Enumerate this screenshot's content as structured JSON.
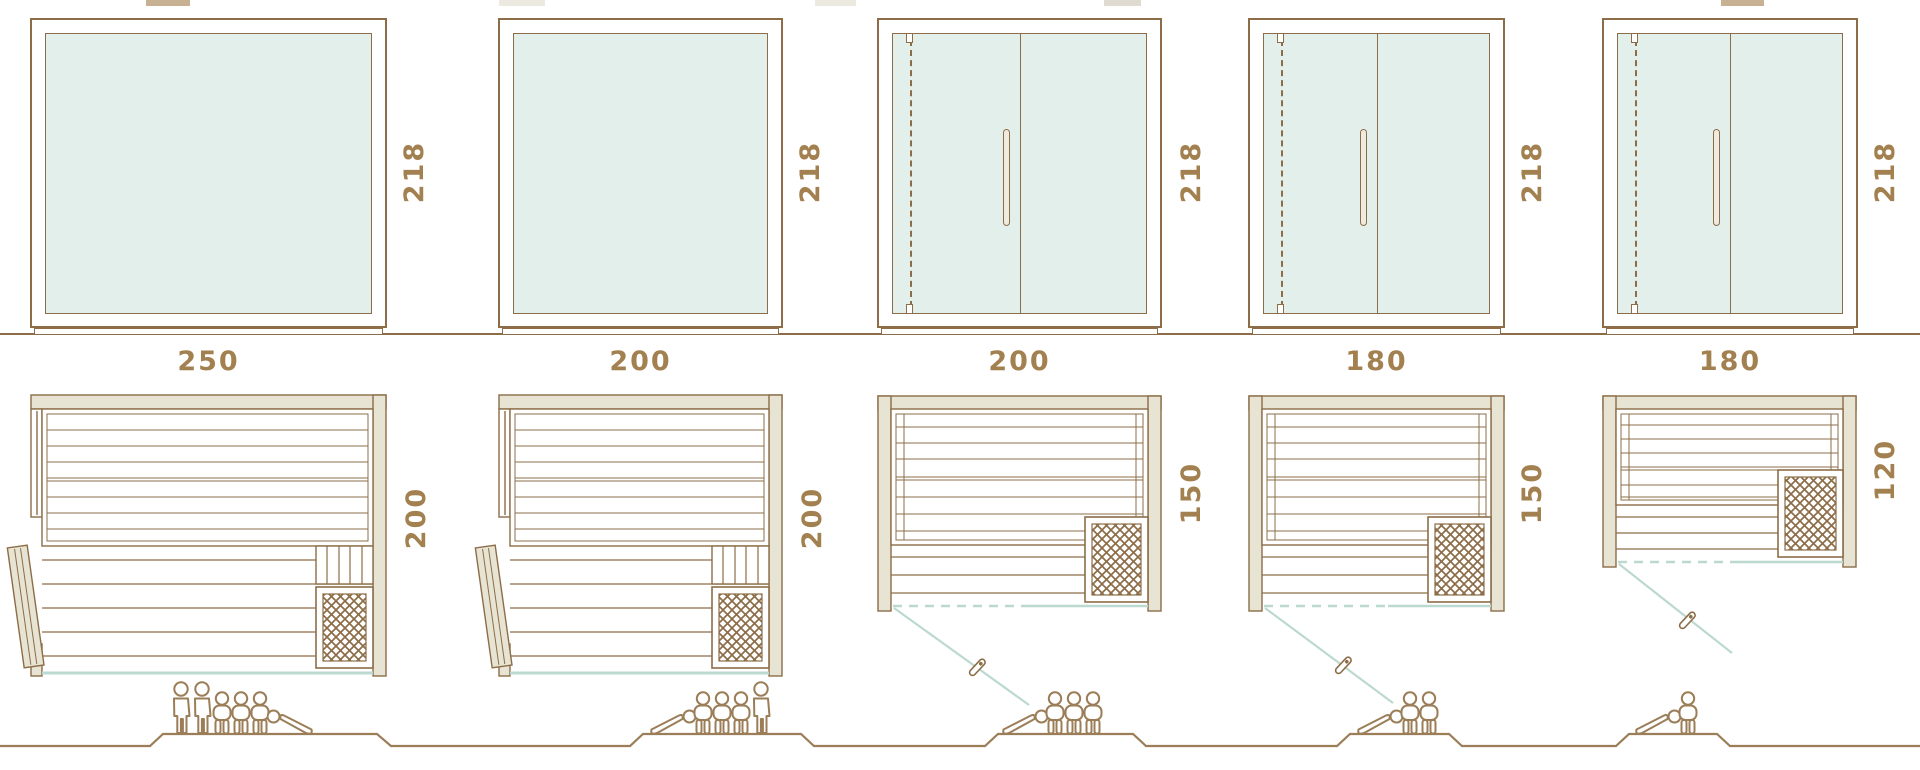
{
  "diagram": {
    "title": "sauna-model-size-comparison",
    "views": [
      "front-elevation",
      "floor-plan",
      "capacity-figures"
    ]
  },
  "colors": {
    "line_brown": "#8c6d48",
    "dimension_text": "#a3804f",
    "wall_fill": "#e7e4d3",
    "glass_fill": "#e3efea",
    "glass_line_blue": "#bcd9d1",
    "figure_line": "#9b7e58"
  },
  "models": [
    {
      "width_label": "250",
      "height_label": "218",
      "depth_label": "200",
      "capacity": 6,
      "figures": {
        "standing": 2,
        "sitting": 3,
        "lying": 1
      }
    },
    {
      "width_label": "200",
      "height_label": "218",
      "depth_label": "200",
      "capacity": 5,
      "figures": {
        "standing": 1,
        "sitting": 3,
        "lying": 1
      }
    },
    {
      "width_label": "200",
      "height_label": "218",
      "depth_label": "150",
      "capacity": 4,
      "figures": {
        "standing": 0,
        "sitting": 3,
        "lying": 1
      }
    },
    {
      "width_label": "180",
      "height_label": "218",
      "depth_label": "150",
      "capacity": 3,
      "figures": {
        "standing": 0,
        "sitting": 2,
        "lying": 1
      }
    },
    {
      "width_label": "180",
      "height_label": "218",
      "depth_label": "120",
      "capacity": 2,
      "figures": {
        "standing": 0,
        "sitting": 1,
        "lying": 1
      }
    }
  ]
}
